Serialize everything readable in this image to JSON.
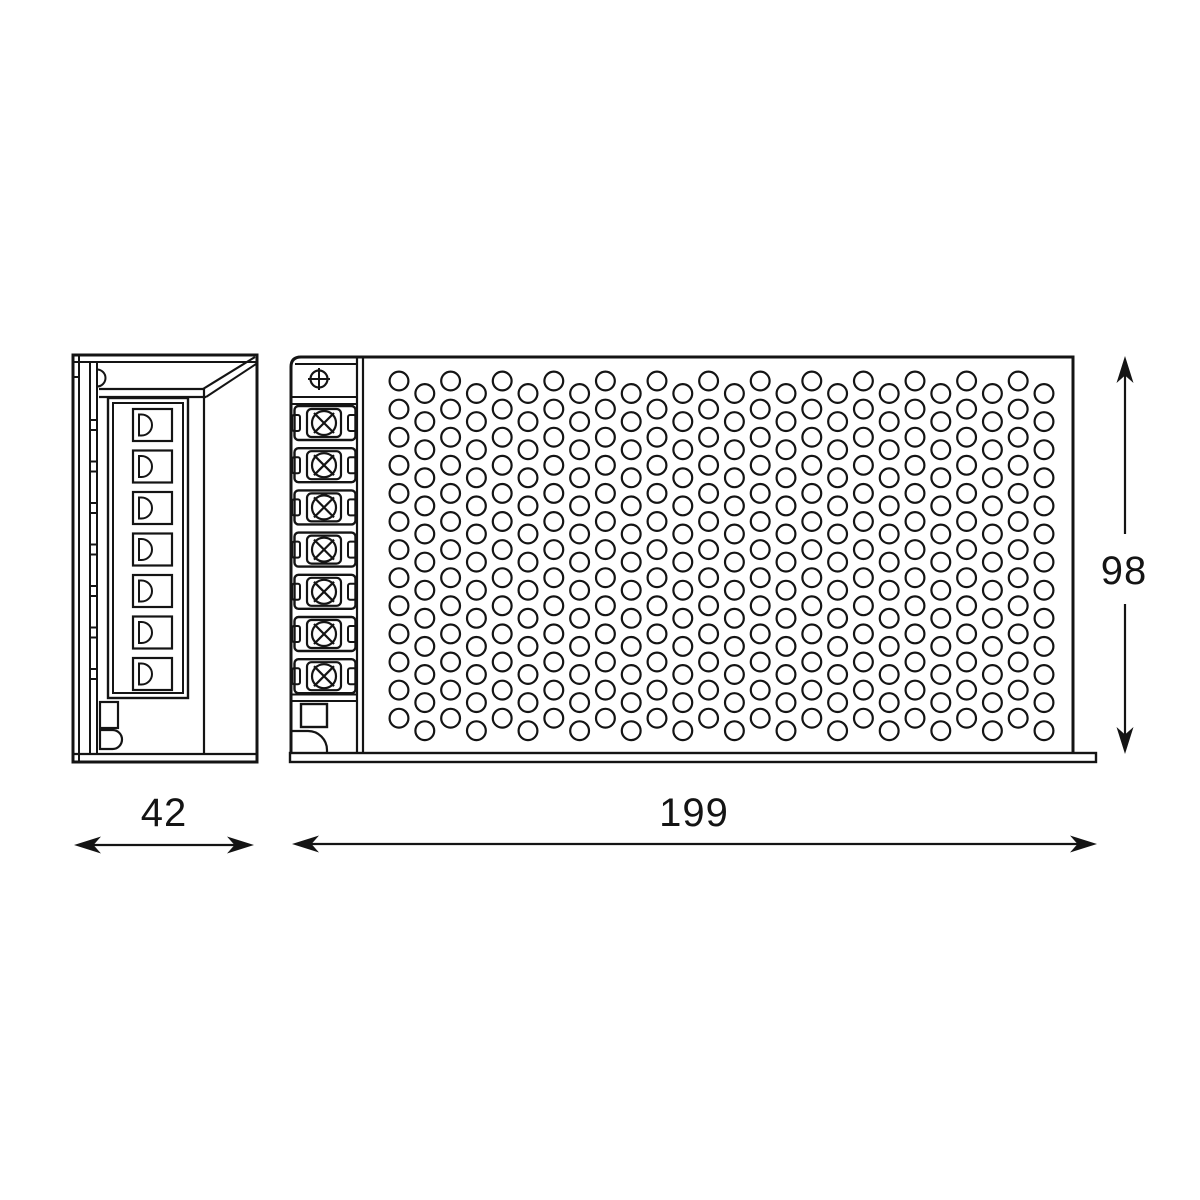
{
  "page": {
    "description": "Technical dimension drawing of a slim enclosed power supply unit: side view and front view with screw-terminal strip and perforated ventilation grid",
    "background": "#ffffff"
  },
  "colors": {
    "line": "#141414",
    "background": "#ffffff"
  },
  "dimensions": {
    "side_width": "42",
    "front_width": "199",
    "front_height": "98"
  },
  "side_view": {
    "connector_slots": 7,
    "rail_ticks": 7
  },
  "front_view": {
    "terminal_blocks": 7,
    "ground_screw_symbol": "circle-with-plus",
    "vent_grid": {
      "columns": 26,
      "rows_per_column": 13
    }
  }
}
